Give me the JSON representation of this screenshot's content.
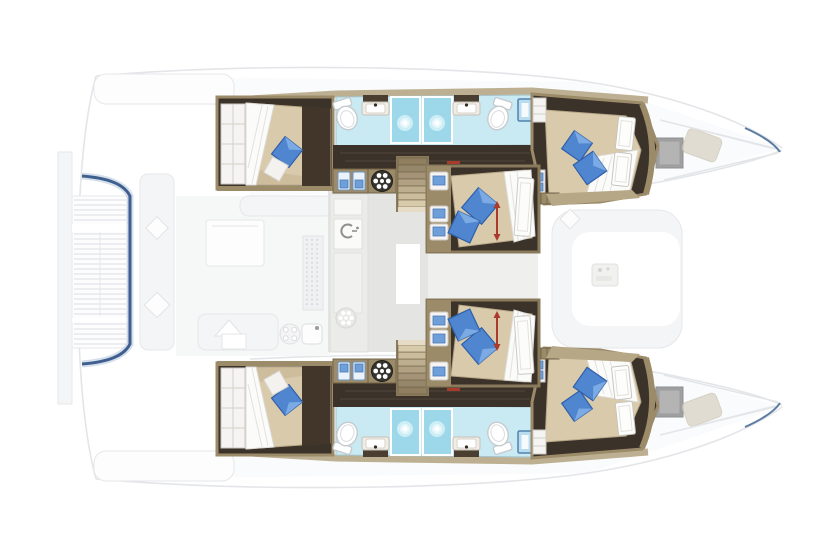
{
  "page": {
    "title": "Catamaran yacht lower-deck floor plan, top-down view, bow to the right"
  },
  "colors": {
    "wood": "#9c8b69",
    "wood_dark": "#73644a",
    "wood_light": "#b6a786",
    "floor_dark": "#3b322a",
    "bed_beige": "#d9caab",
    "bed_shade": "#c2b292",
    "duvet_white": "#fbfbfa",
    "pillow_blue": "#4f86cf",
    "pillow_blue_dark": "#2f5fa8",
    "pillow_white": "#f3f2ef",
    "bathroom_blue": "#c9eaf3",
    "shower_blue": "#9cd7ea",
    "towel_blue": "#6f9fd8",
    "door_blue": "#badcef",
    "water_blue": "#3f5f8e",
    "hatch_gray": "#a0a0a0",
    "salon_gray": "#e1e2e0",
    "ghost_line": "#e3e5e8",
    "ghost_fill": "#f4f5f6",
    "accent_red": "#a93a2c"
  },
  "plan": {
    "view": "top-down",
    "bow": "right",
    "stern": "left",
    "hulls": [
      {
        "side": "port",
        "position": "top",
        "rooms": [
          "aft-cabin",
          "bathroom",
          "shower",
          "shower",
          "bathroom",
          "forward-cabin"
        ],
        "fixtures": {
          "toilets": 2,
          "sinks": 2,
          "shower_stalls": 2,
          "double_beds": 2,
          "wardrobes": 2,
          "staircase": 1
        }
      },
      {
        "side": "starboard",
        "position": "bottom",
        "rooms": [
          "aft-cabin",
          "bathroom",
          "shower",
          "shower",
          "bathroom",
          "forward-cabin"
        ],
        "fixtures": {
          "toilets": 2,
          "sinks": 2,
          "shower_stalls": 2,
          "double_beds": 2,
          "wardrobes": 2,
          "staircase": 1
        }
      }
    ],
    "center_cabins": [
      {
        "position": "upper",
        "features": [
          "diagonal-double-bed",
          "two-blue-pillows",
          "white-duvet",
          "shelf-column-with-towels",
          "red-dimension-arrow"
        ]
      },
      {
        "position": "lower",
        "features": [
          "diagonal-double-bed",
          "two-blue-pillows",
          "white-duvet",
          "shelf-column-with-towels",
          "red-dimension-arrow"
        ]
      }
    ],
    "ghosted_deck_elements": [
      "stern-swim-platform-slats",
      "stern-water-edge",
      "aft-cockpit-bench",
      "cockpit-table",
      "cockpit-sofa",
      "galley-counter",
      "galley-sink",
      "stove-burner",
      "salon-floor",
      "forward-cockpit-seating",
      "forward-cockpit-table",
      "bow-deck-hatches",
      "bow-sun-pads"
    ],
    "totals": {
      "cabins": 6,
      "double_beds": 6,
      "toilets": 4,
      "sinks": 4,
      "shower_stalls": 4
    }
  }
}
